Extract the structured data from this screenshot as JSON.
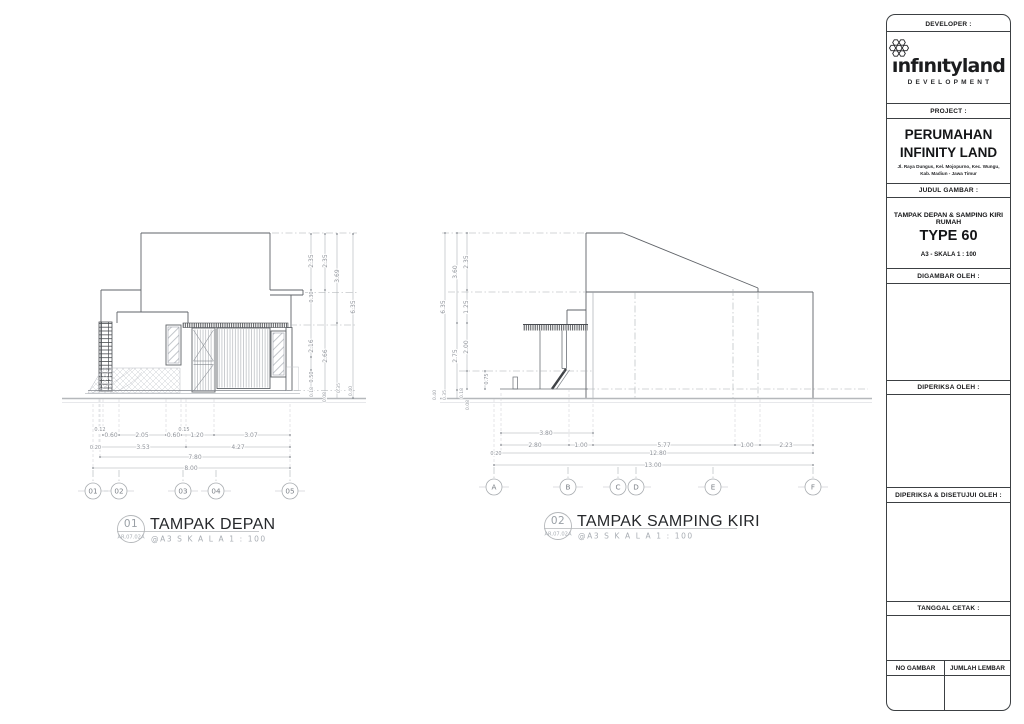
{
  "title_block": {
    "developer_label": "DEVELOPER :",
    "logo": {
      "icon": "flower-hex-icon",
      "wordmark": "ınfınıtyland",
      "subtitle": "DEVELOPMENT"
    },
    "project_label": "PROJECT :",
    "project_name_1": "PERUMAHAN",
    "project_name_2": "INFINITY LAND",
    "project_address_1": "Jl. Raya Dungus, Kel. Mojopurno, Kec. Wungu,",
    "project_address_2": "Kab. Madiun - Jawa Timur",
    "judul_label": "JUDUL GAMBAR :",
    "judul_line_1": "TAMPAK DEPAN & SAMPING KIRI RUMAH",
    "judul_line_2": "TYPE 60",
    "judul_line_3": "A3 - SKALA 1 : 100",
    "digambar_label": "DIGAMBAR OLEH :",
    "diperiksa_label": "DIPERIKSA OLEH :",
    "disetujui_label": "DIPERIKSA & DISETUJUI OLEH :",
    "tanggal_label": "TANGGAL CETAK :",
    "no_gambar_label": "NO GAMBAR",
    "jumlah_lembar_label": "JUMLAH LEMBAR"
  },
  "fig1": {
    "number": "01",
    "code": "AR.07.02A",
    "title": "TAMPAK DEPAN",
    "scale": "@A3 S K A L A  1 : 100",
    "grid": [
      "01",
      "02",
      "03",
      "04",
      "05"
    ],
    "dh": [
      "0.12",
      "0.15",
      "0.60",
      "2.05",
      "0.60",
      "1.20",
      "3.07",
      "0.20",
      "3.53",
      "4.27",
      "7.80",
      "8.00"
    ],
    "dv": [
      "2.35",
      "2.35",
      "3.69",
      "0.30",
      "6.35",
      "2.16",
      "2.66",
      "0.50",
      "0.18",
      "0.08",
      "0.35",
      "0.40"
    ]
  },
  "fig2": {
    "number": "02",
    "code": "AR.07.02A",
    "title": "TAMPAK SAMPING KIRI",
    "scale": "@A3 S K A L A  1 : 100",
    "grid": [
      "A",
      "B",
      "C",
      "D",
      "E",
      "F"
    ],
    "dh": [
      "3.80",
      "2.80",
      "1.00",
      "5.77",
      "1.00",
      "2.23",
      "0.20",
      "12.80",
      "13.00"
    ],
    "dv": [
      "6.35",
      "3.60",
      "2.75",
      "2.35",
      "1.25",
      "2.00",
      "0.75",
      "0.40",
      "0.35",
      "0.18",
      "0.08"
    ]
  },
  "colors": {
    "line": "#5f6368",
    "dim_text": "#8f939a",
    "title_text": "#26282b",
    "ground": "#b5b8bb",
    "panel_border": "#3c4043"
  }
}
